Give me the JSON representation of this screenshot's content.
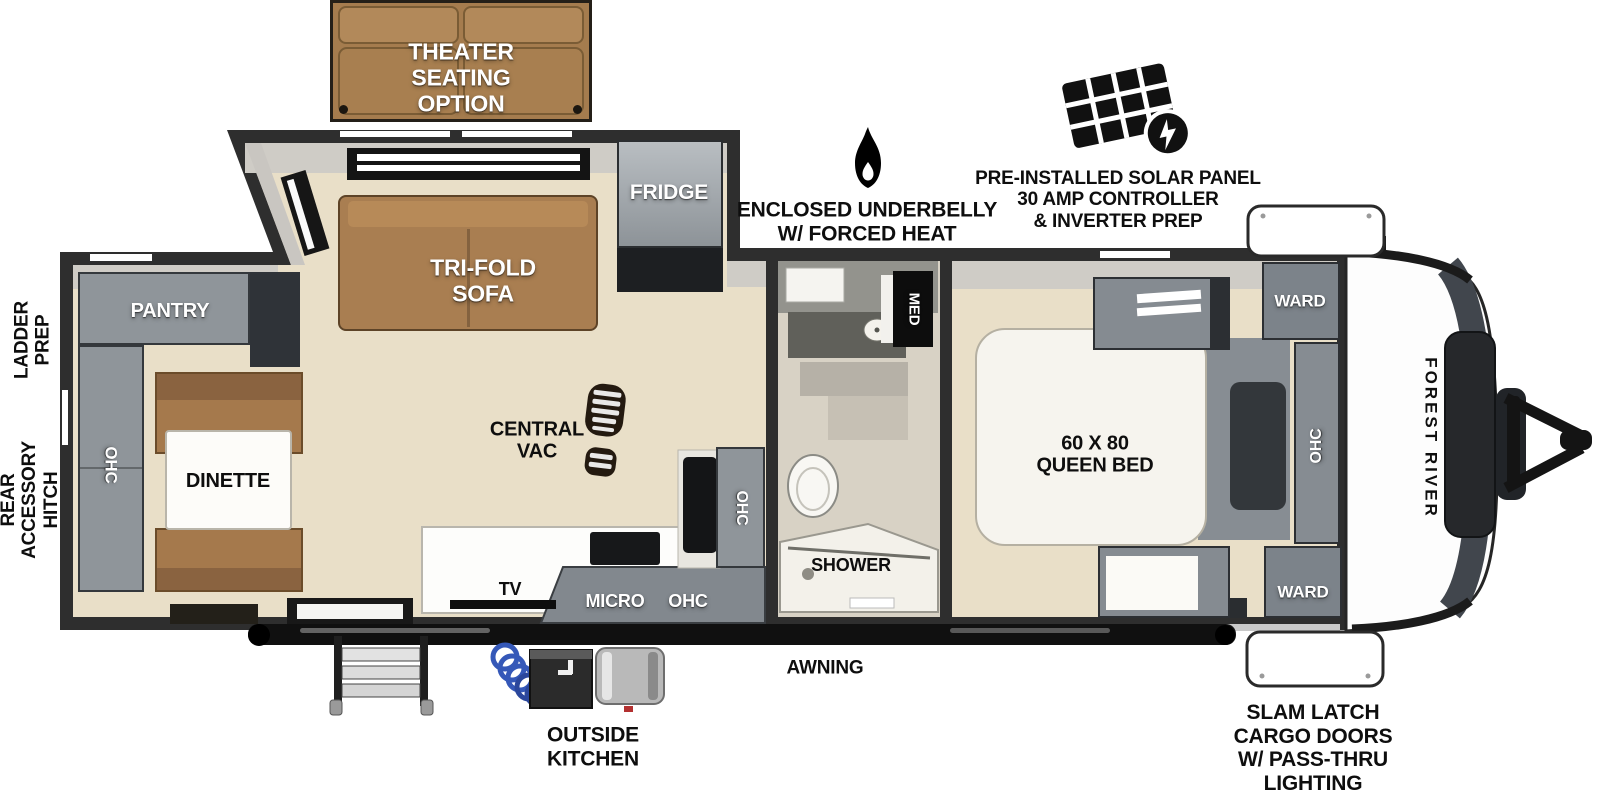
{
  "colors": {
    "wall": "#2e2e2e",
    "floor_wood": "#e9dfc8",
    "floor_tile": "#d8d2c5",
    "cabinet_gray": "#8f959a",
    "cabinet_dark": "#2f3338",
    "sofa_brown": "#a97e51",
    "counter_white": "#fdfdfb",
    "hose_blue": "#3558b8",
    "label_black": "#0e0e0e",
    "label_white": "#ffffff"
  },
  "exterior": {
    "ladder_prep": [
      "LADDER",
      "PREP"
    ],
    "rear_accessory_hitch": [
      "REAR",
      "ACCESSORY",
      "HITCH"
    ],
    "enclosed_underbelly": [
      "ENCLOSED UNDERBELLY",
      "W/ FORCED HEAT"
    ],
    "solar_panel": [
      "PRE-INSTALLED SOLAR PANEL",
      "30 AMP CONTROLLER",
      "& INVERTER PREP"
    ],
    "awning": "AWNING",
    "outside_kitchen": [
      "OUTSIDE",
      "KITCHEN"
    ],
    "slam_latch": [
      "SLAM LATCH",
      "CARGO DOORS",
      "W/ PASS-THRU",
      "LIGHTING"
    ],
    "brand": "FOREST RIVER"
  },
  "interior": {
    "theater_seating": [
      "THEATER",
      "SEATING",
      "OPTION"
    ],
    "tri_fold_sofa": [
      "TRI-FOLD",
      "SOFA"
    ],
    "fridge": "FRIDGE",
    "pantry": "PANTRY",
    "ohc_rear": "OHC",
    "dinette": "DINETTE",
    "central_vac": [
      "CENTRAL",
      "VAC"
    ],
    "tv": "TV",
    "micro": "MICRO",
    "ohc_counter": "OHC",
    "ohc_kitchen": "OHC",
    "med": "MED",
    "shower": "SHOWER",
    "queen_bed": [
      "60 X 80",
      "QUEEN BED"
    ],
    "ward_front_top": "WARD",
    "ward_front_bottom": "WARD",
    "ohc_bedroom": "OHC"
  }
}
